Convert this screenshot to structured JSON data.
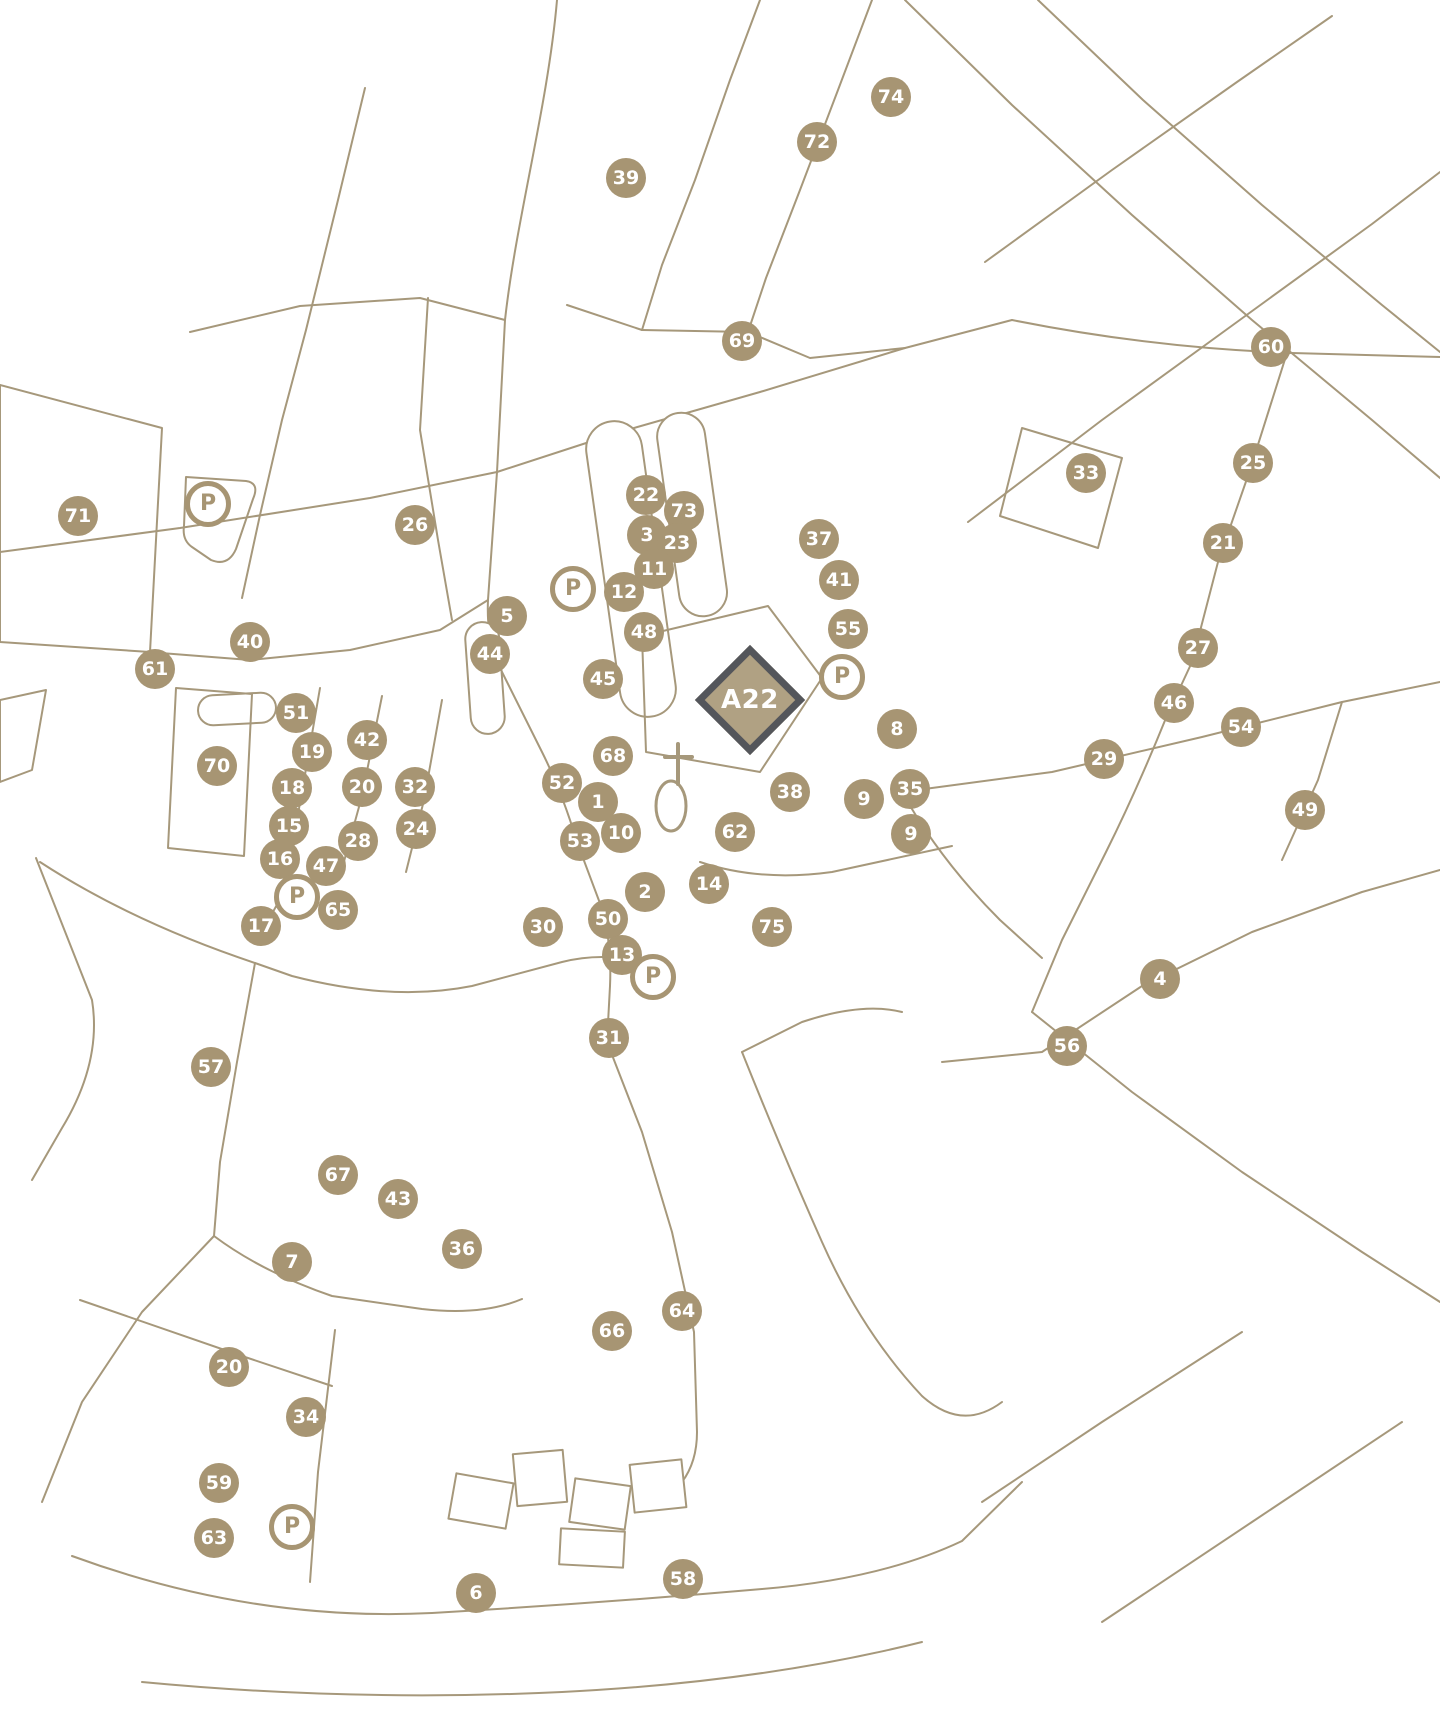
{
  "map": {
    "parking_label": "P",
    "colors": {
      "marker_fill": "#a79573",
      "street_line": "#a6987b",
      "highlight_fill": "#b0a183",
      "highlight_border": "#54565b",
      "marker_text": "#ffffff",
      "background": "#ffffff"
    },
    "highlight": {
      "label": "A22",
      "x": 750,
      "y": 700
    },
    "markers": [
      {
        "label": "74",
        "x": 891,
        "y": 97
      },
      {
        "label": "72",
        "x": 817,
        "y": 142
      },
      {
        "label": "39",
        "x": 626,
        "y": 178
      },
      {
        "label": "69",
        "x": 742,
        "y": 341
      },
      {
        "label": "60",
        "x": 1271,
        "y": 347
      },
      {
        "label": "25",
        "x": 1253,
        "y": 463
      },
      {
        "label": "33",
        "x": 1086,
        "y": 473
      },
      {
        "label": "22",
        "x": 646,
        "y": 495
      },
      {
        "label": "P",
        "type": "parking",
        "x": 208,
        "y": 504
      },
      {
        "label": "73",
        "x": 684,
        "y": 511
      },
      {
        "label": "71",
        "x": 78,
        "y": 516
      },
      {
        "label": "26",
        "x": 415,
        "y": 525
      },
      {
        "label": "3",
        "x": 647,
        "y": 535
      },
      {
        "label": "37",
        "x": 819,
        "y": 539
      },
      {
        "label": "23",
        "x": 677,
        "y": 543
      },
      {
        "label": "21",
        "x": 1223,
        "y": 543
      },
      {
        "label": "11",
        "x": 654,
        "y": 569
      },
      {
        "label": "41",
        "x": 839,
        "y": 580
      },
      {
        "label": "P",
        "type": "parking",
        "x": 573,
        "y": 589
      },
      {
        "label": "12",
        "x": 624,
        "y": 592
      },
      {
        "label": "5",
        "x": 507,
        "y": 616
      },
      {
        "label": "55",
        "x": 848,
        "y": 629
      },
      {
        "label": "48",
        "x": 644,
        "y": 632
      },
      {
        "label": "40",
        "x": 250,
        "y": 642
      },
      {
        "label": "27",
        "x": 1198,
        "y": 648
      },
      {
        "label": "44",
        "x": 490,
        "y": 654
      },
      {
        "label": "61",
        "x": 155,
        "y": 669
      },
      {
        "label": "P",
        "type": "parking",
        "x": 842,
        "y": 677
      },
      {
        "label": "45",
        "x": 603,
        "y": 679
      },
      {
        "label": "46",
        "x": 1174,
        "y": 703
      },
      {
        "label": "51",
        "x": 296,
        "y": 713
      },
      {
        "label": "54",
        "x": 1241,
        "y": 727
      },
      {
        "label": "8",
        "x": 897,
        "y": 729
      },
      {
        "label": "42",
        "x": 367,
        "y": 740
      },
      {
        "label": "19",
        "x": 312,
        "y": 752
      },
      {
        "label": "68",
        "x": 613,
        "y": 756
      },
      {
        "label": "29",
        "x": 1104,
        "y": 759
      },
      {
        "label": "70",
        "x": 217,
        "y": 766
      },
      {
        "label": "52",
        "x": 562,
        "y": 783
      },
      {
        "label": "20",
        "x": 362,
        "y": 787
      },
      {
        "label": "32",
        "x": 415,
        "y": 787
      },
      {
        "label": "18",
        "x": 292,
        "y": 788
      },
      {
        "label": "35",
        "x": 910,
        "y": 789
      },
      {
        "label": "38",
        "x": 790,
        "y": 792
      },
      {
        "label": "9",
        "x": 864,
        "y": 799
      },
      {
        "label": "1",
        "x": 598,
        "y": 802
      },
      {
        "label": "49",
        "x": 1305,
        "y": 810
      },
      {
        "label": "15",
        "x": 289,
        "y": 826
      },
      {
        "label": "24",
        "x": 416,
        "y": 829
      },
      {
        "label": "10",
        "x": 621,
        "y": 833
      },
      {
        "label": "62",
        "x": 735,
        "y": 832
      },
      {
        "label": "9",
        "x": 911,
        "y": 834
      },
      {
        "label": "53",
        "x": 580,
        "y": 841
      },
      {
        "label": "28",
        "x": 358,
        "y": 841
      },
      {
        "label": "16",
        "x": 280,
        "y": 859
      },
      {
        "label": "47",
        "x": 326,
        "y": 866
      },
      {
        "label": "14",
        "x": 709,
        "y": 884
      },
      {
        "label": "2",
        "x": 645,
        "y": 892
      },
      {
        "label": "P",
        "type": "parking",
        "x": 297,
        "y": 897
      },
      {
        "label": "65",
        "x": 338,
        "y": 910
      },
      {
        "label": "50",
        "x": 608,
        "y": 919
      },
      {
        "label": "17",
        "x": 261,
        "y": 926
      },
      {
        "label": "30",
        "x": 543,
        "y": 927
      },
      {
        "label": "75",
        "x": 772,
        "y": 927
      },
      {
        "label": "13",
        "x": 622,
        "y": 955
      },
      {
        "label": "P",
        "type": "parking",
        "x": 653,
        "y": 977
      },
      {
        "label": "4",
        "x": 1160,
        "y": 979
      },
      {
        "label": "31",
        "x": 609,
        "y": 1038
      },
      {
        "label": "56",
        "x": 1067,
        "y": 1046
      },
      {
        "label": "57",
        "x": 211,
        "y": 1067
      },
      {
        "label": "67",
        "x": 338,
        "y": 1175
      },
      {
        "label": "43",
        "x": 398,
        "y": 1199
      },
      {
        "label": "36",
        "x": 462,
        "y": 1249
      },
      {
        "label": "7",
        "x": 292,
        "y": 1262
      },
      {
        "label": "64",
        "x": 682,
        "y": 1311
      },
      {
        "label": "66",
        "x": 612,
        "y": 1331
      },
      {
        "label": "20",
        "x": 229,
        "y": 1367
      },
      {
        "label": "34",
        "x": 306,
        "y": 1417
      },
      {
        "label": "59",
        "x": 219,
        "y": 1483
      },
      {
        "label": "P",
        "type": "parking",
        "x": 292,
        "y": 1527
      },
      {
        "label": "63",
        "x": 214,
        "y": 1538
      },
      {
        "label": "58",
        "x": 683,
        "y": 1579
      },
      {
        "label": "6",
        "x": 476,
        "y": 1593
      }
    ]
  }
}
